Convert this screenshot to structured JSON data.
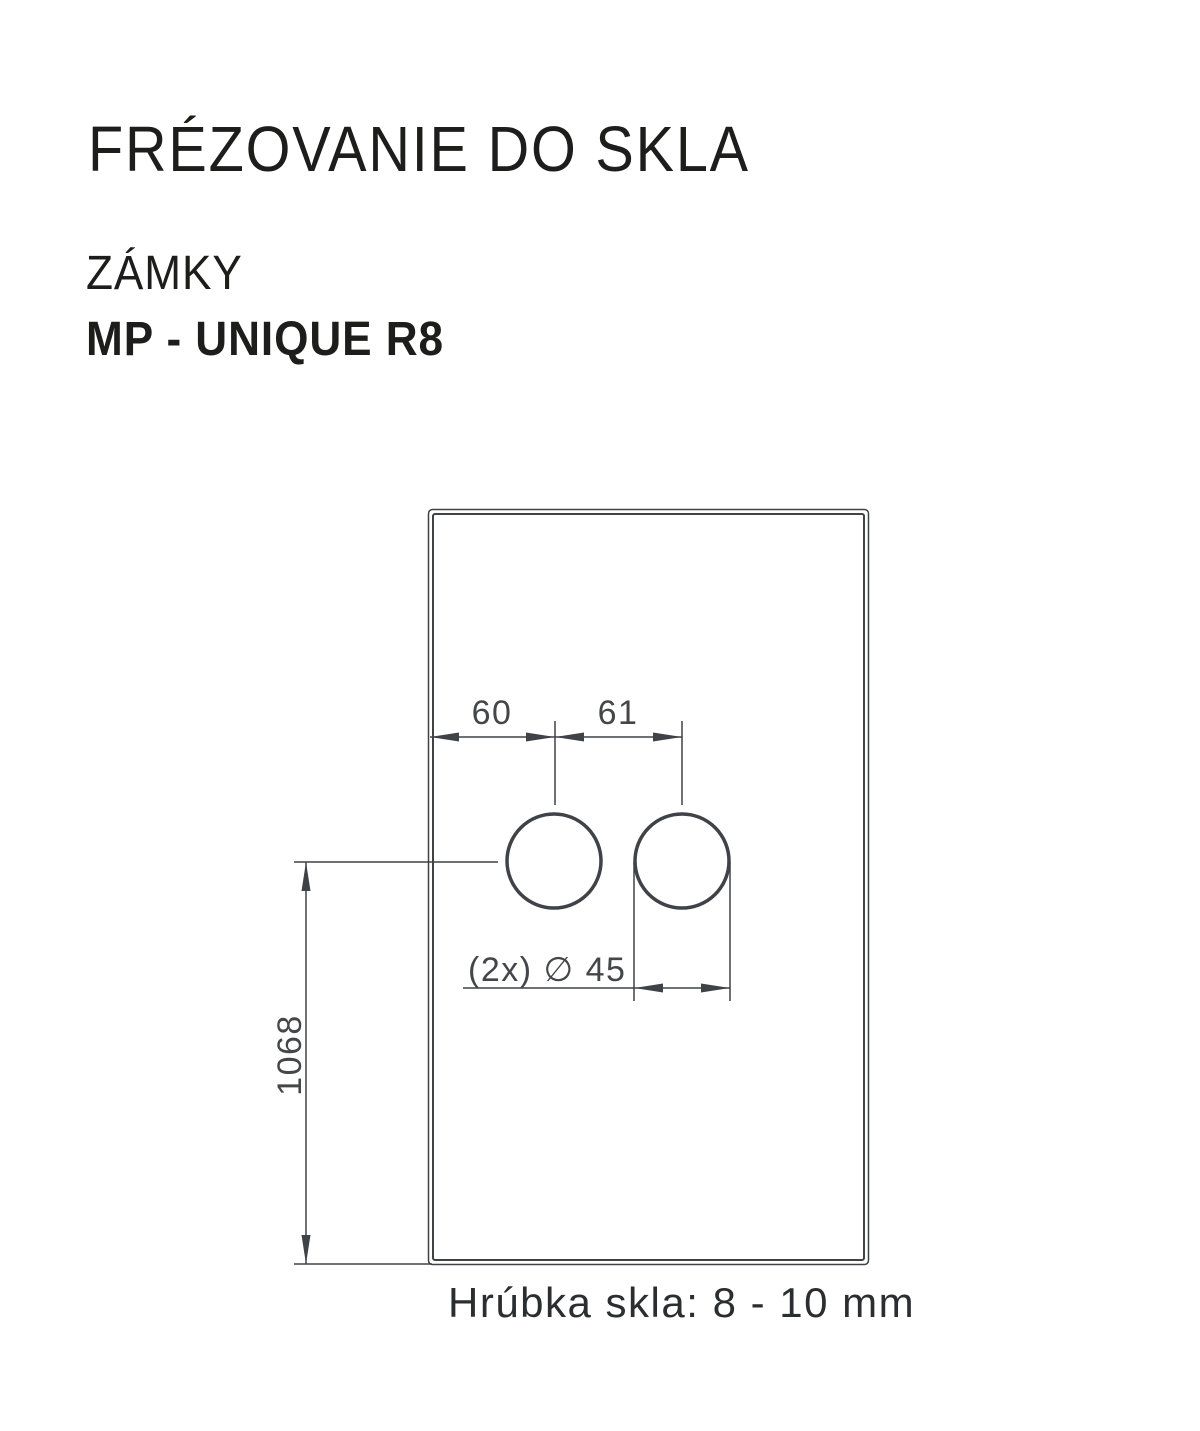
{
  "header": {
    "title": "FRÉZOVANIE DO SKLA",
    "category": "ZÁMKY",
    "product": "MP - UNIQUE R8"
  },
  "drawing": {
    "labels": {
      "dim_edge_to_hole": "60",
      "dim_hole_spacing": "61",
      "dim_bottom_to_hole": "1068",
      "holes": "(2x) ∅ 45",
      "thickness": "Hrúbka skla: 8 - 10 mm"
    },
    "dimensions_mm": {
      "left_edge_to_first_hole_center": 60,
      "hole_center_to_center": 61,
      "hole_diameter": 45,
      "hole_count": 2,
      "bottom_edge_to_hole_center": 1068,
      "glass_thickness": "8 - 10 mm"
    },
    "colors": {
      "line": "#3f4347",
      "dimension_text": "#43474a",
      "heading_text": "#1d1d1b",
      "background": "#ffffff"
    }
  }
}
